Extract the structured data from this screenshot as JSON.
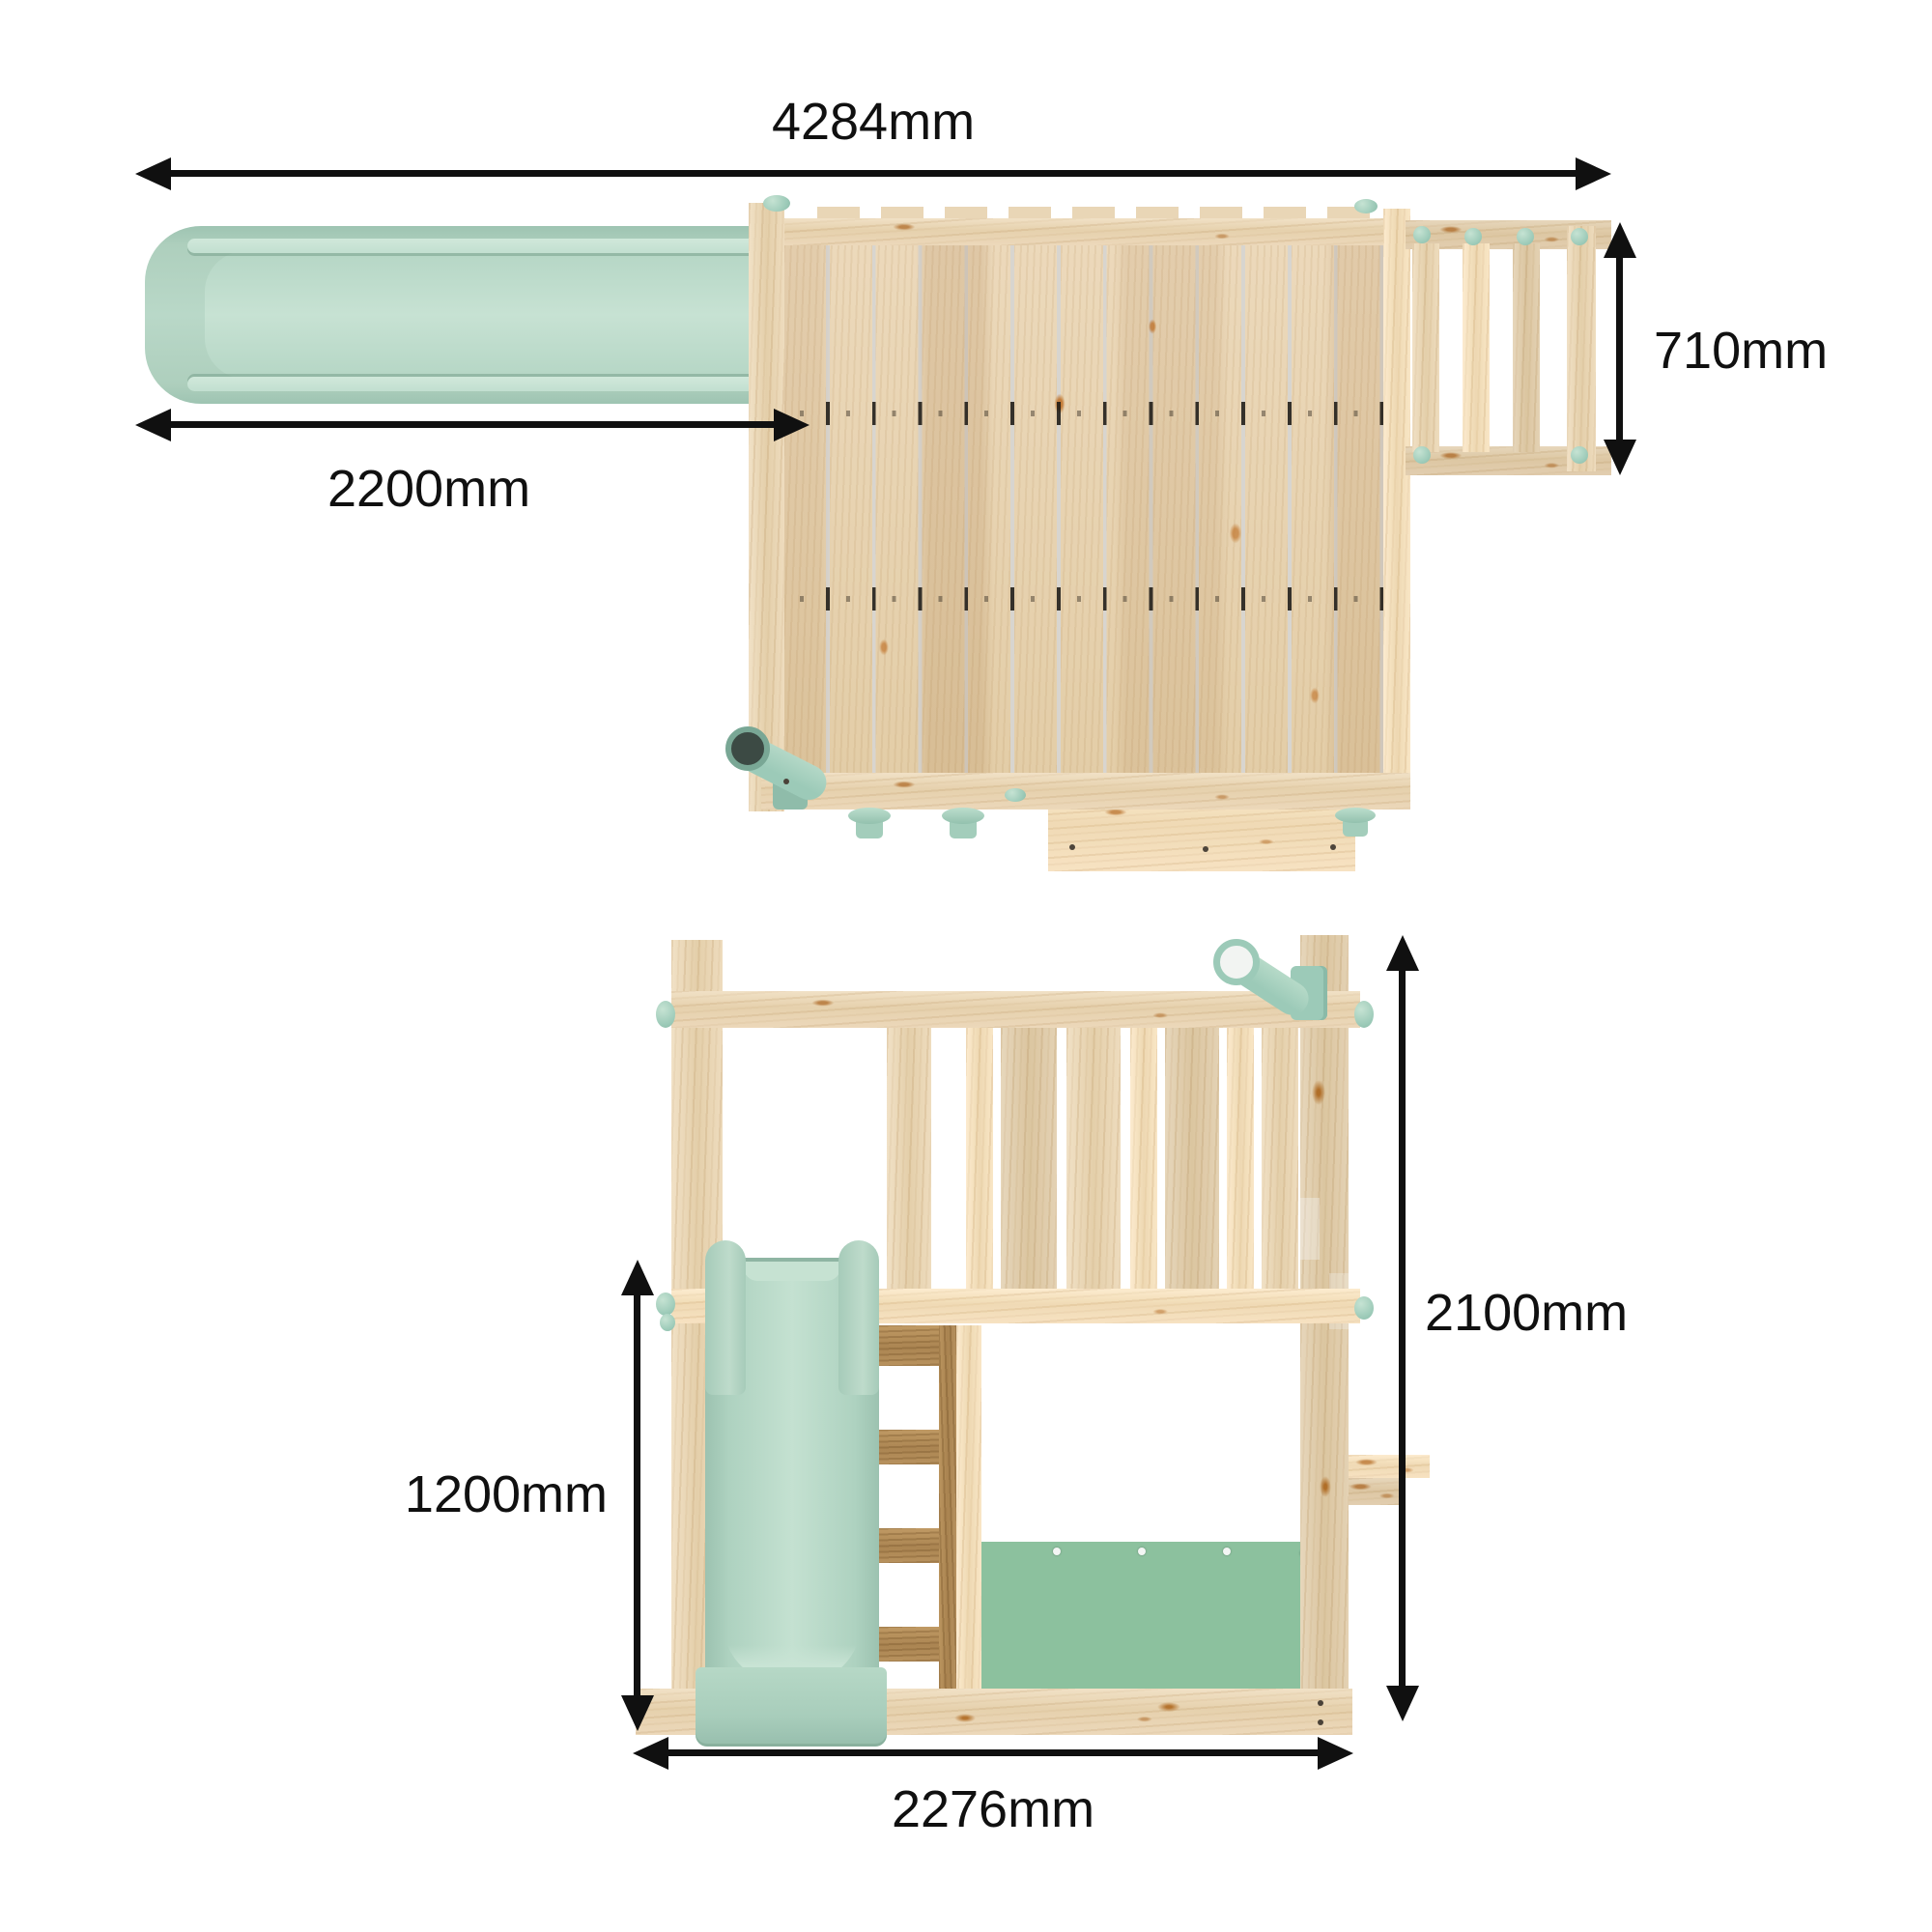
{
  "diagram": {
    "type": "product-dimension-diagram",
    "subject": "wooden-playset-with-slide-and-ladder",
    "background": "#ffffff",
    "views": {
      "top_view": {
        "name": "Top view (plan)",
        "dimensions": {
          "overall_width": {
            "label": "4284mm",
            "orientation": "horizontal"
          },
          "slide_length": {
            "label": "2200mm",
            "orientation": "horizontal"
          },
          "ladder_width": {
            "label": "710mm",
            "orientation": "vertical"
          }
        }
      },
      "front_view": {
        "name": "Front view (elevation)",
        "dimensions": {
          "overall_height": {
            "label": "2100mm",
            "orientation": "vertical"
          },
          "slide_height": {
            "label": "1200mm",
            "orientation": "vertical"
          },
          "base_width": {
            "label": "2276mm",
            "orientation": "horizontal"
          }
        }
      }
    },
    "colors": {
      "slide_mint": "#b7d8c7",
      "slide_mint_dark": "#9ec4b2",
      "slide_mint_light": "#c7e2d3",
      "accent_mint": "#9ccab8",
      "wood_light": "#ecd9ba",
      "wood_mid": "#e3cda7",
      "wood_dark": "#ab8552",
      "panel_green": "#8cc19e",
      "dimension_black": "#101010"
    }
  }
}
